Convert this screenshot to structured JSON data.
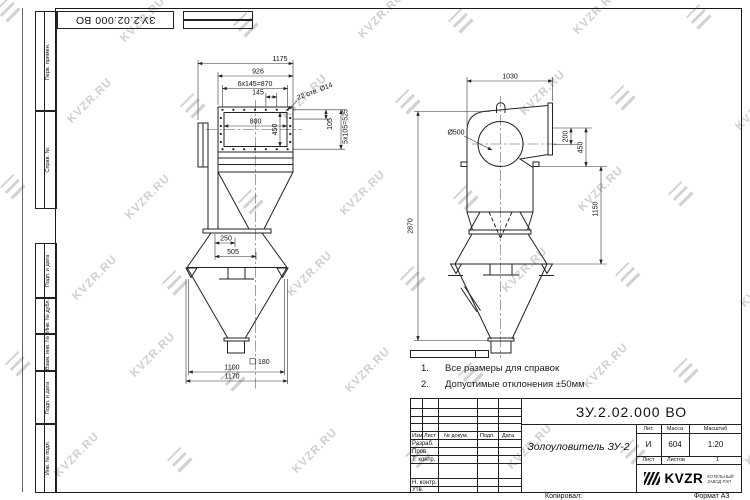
{
  "watermark": {
    "text": "KVZR.RU"
  },
  "corner_stamp": {
    "doc_number": "ЗУ.2.02.000 ВО"
  },
  "margin_columns": {
    "top": [
      {
        "label": "Перв. примен."
      },
      {
        "label": "Справ. №"
      }
    ],
    "bottom": [
      {
        "label": "Подп. и дата"
      },
      {
        "label": "Инв. № дубл."
      },
      {
        "label": "Взам. инв. №"
      },
      {
        "label": "Подп. и дата"
      },
      {
        "label": "Инв. № подл."
      }
    ]
  },
  "front_dims": {
    "d1175": "1175",
    "d926": "926",
    "d870": "6х145=870",
    "d145": "145",
    "holes": "22 отв. Ø14",
    "d800": "800",
    "d450": "450",
    "d105": "105",
    "d525": "5х105=525",
    "d250": "250",
    "d505": "505",
    "d180": "180",
    "d1100": "1100",
    "d1170": "1170"
  },
  "side_dims": {
    "d1030": "1030",
    "d500": "Ø500",
    "d200": "200",
    "d450": "450",
    "d1150": "1150",
    "d2870": "2870"
  },
  "notes": {
    "items": [
      {
        "num": "1.",
        "text": "Все размеры для справок"
      },
      {
        "num": "2.",
        "text": "Допустимые отклонения ±50мм"
      }
    ]
  },
  "title_block": {
    "doc_number": "ЗУ.2.02.000 ВО",
    "product_name": "Золоуловитель ЗУ-2",
    "header_cols": [
      "Изм.",
      "Лист",
      "№ докум.",
      "Подп.",
      "Дата"
    ],
    "staff_rows": [
      "Разраб.",
      "Пров.",
      "Т. контр.",
      "Н. контр.",
      "Утв."
    ],
    "lit_label": "Лит.",
    "lit_value": "И",
    "mass_label": "Масса",
    "mass_value": "604",
    "scale_label": "Масштаб",
    "scale_value": "1:20",
    "sheet_label": "Лист",
    "sheets_label": "Листов",
    "sheets_value": "1",
    "logo_text": "KVZR",
    "logo_sub_line1": "КОТЕЛЬНЫЙ",
    "logo_sub_line2": "ЗАВОД РЭП",
    "copied_label": "Копировал:",
    "format_label": "Формат А3"
  }
}
